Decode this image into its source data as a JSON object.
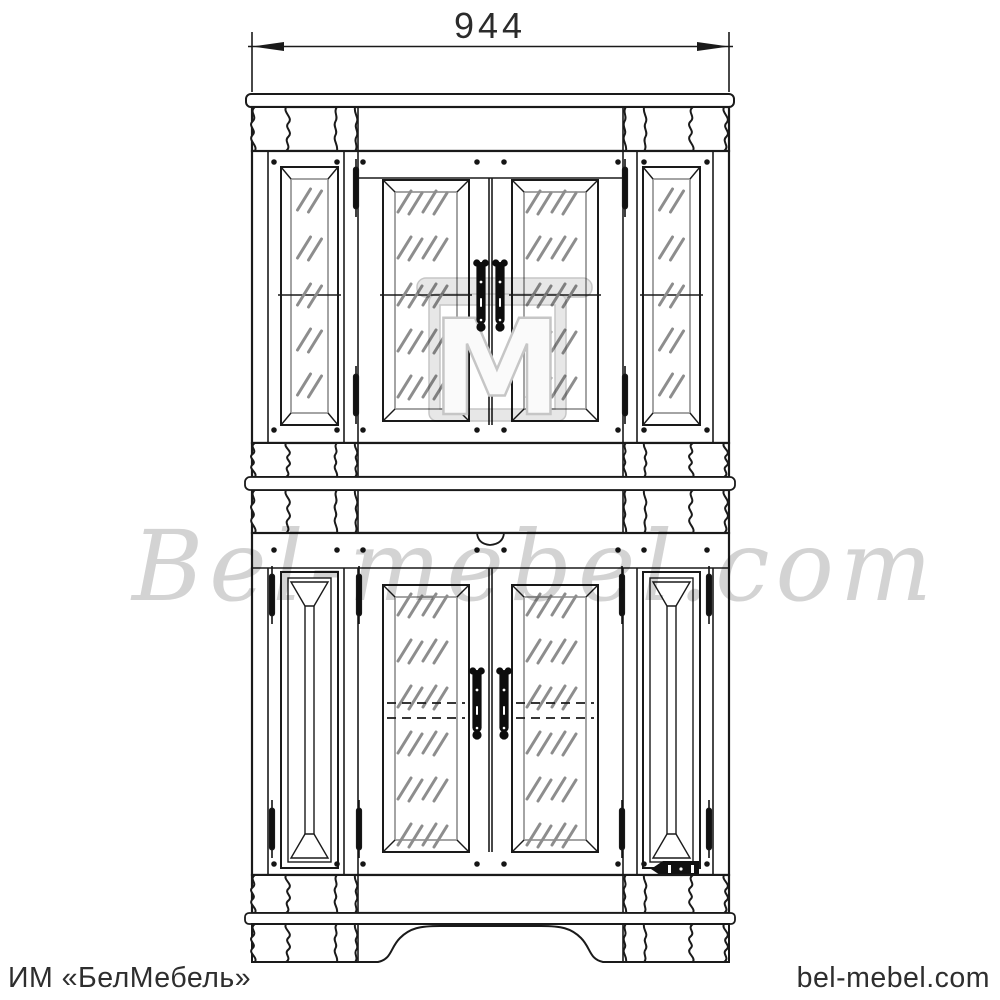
{
  "dimension": {
    "width": "944"
  },
  "watermark": {
    "script": "Bel-mebel.com",
    "logo_letter": "М"
  },
  "footer": {
    "left": "ИМ «БелМебель»",
    "right": "bel-mebel.com"
  },
  "colors": {
    "background": "#ffffff",
    "line": "#1a1a1a",
    "glass_hatch": "#8d8d8d",
    "glass_edge": "#9a9a9a",
    "watermark_gray": "#c9c9c9",
    "footer_text": "#2e2e2e"
  }
}
